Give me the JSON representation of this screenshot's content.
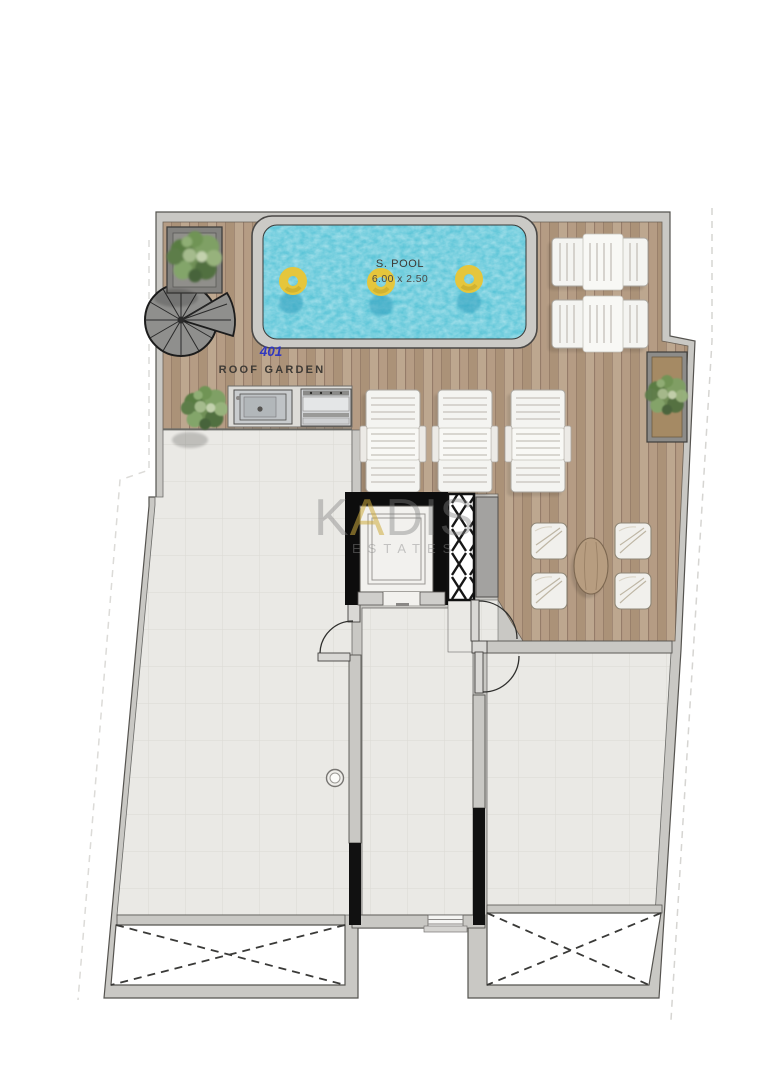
{
  "plan": {
    "unit_number": "401",
    "room_label": "ROOF GARDEN",
    "pool": {
      "label": "S. POOL",
      "dimensions": "6.00 x 2.50"
    },
    "watermark": {
      "part1": "K",
      "part2": "A",
      "part3": "DIS",
      "subtitle": "ESTATES"
    },
    "furniture": {
      "pool_floats": 3,
      "sun_loungers_horizontal": 2,
      "sun_loungers_vertical": 3,
      "armchairs": 4,
      "coffee_tables": 1,
      "planters": 3,
      "void_openings": 2
    }
  },
  "colors": {
    "deck": "#b59c84",
    "deck_line": "#8a7160",
    "tile": "#eae9e5",
    "tile_line": "#dbd9d3",
    "wall": "#c9c8c4",
    "wall_edge": "#55534f",
    "pool_water": "#4fc0d4",
    "pool_ring": "#e5c63c",
    "accent_blue": "#3038c0",
    "ink": "#3e3a35"
  }
}
